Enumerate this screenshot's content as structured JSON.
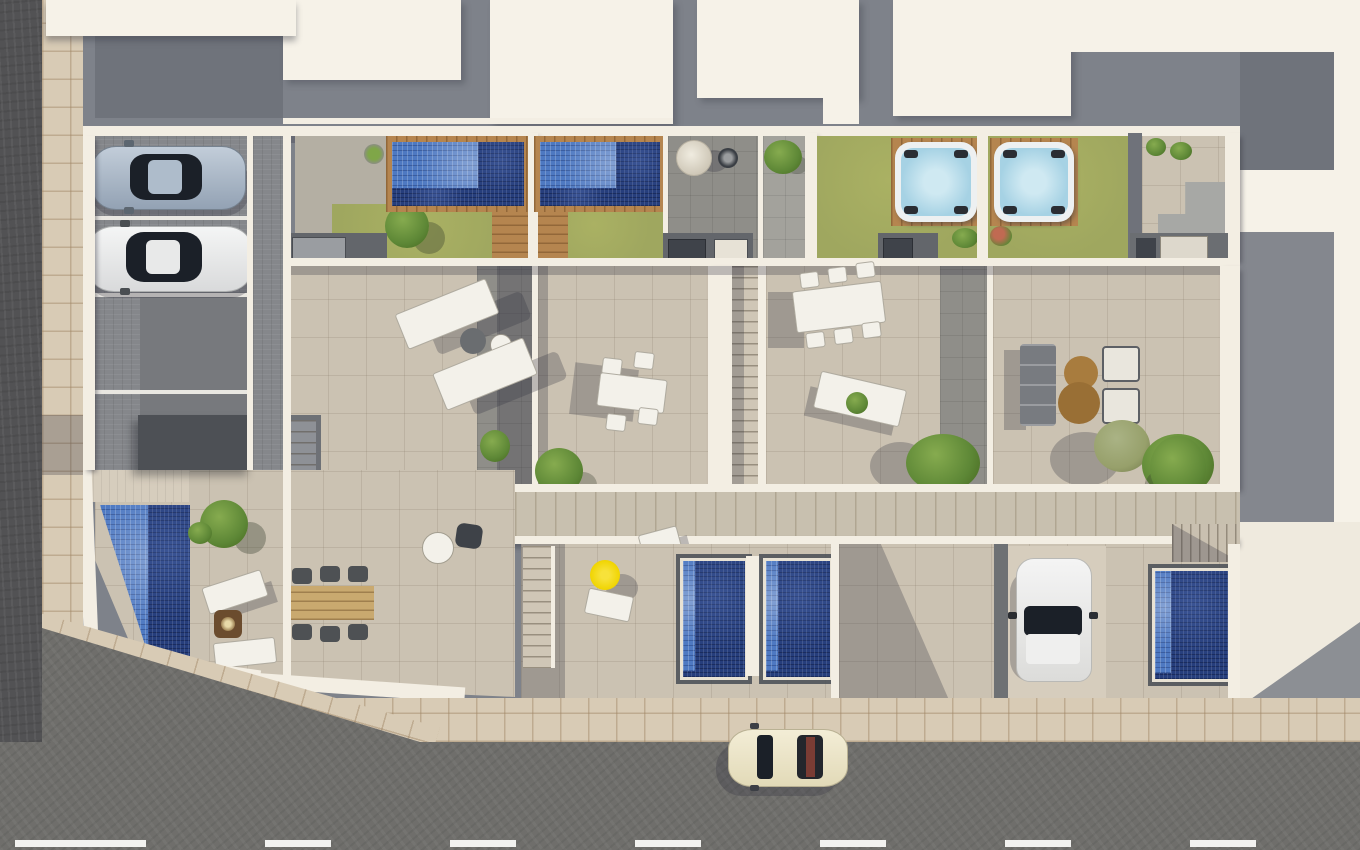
{
  "meta": {
    "title": "Aerial 3D render of residential complex with rooftop terraces and pools",
    "render_type": "architectural-aerial-visualization",
    "visible_text": []
  },
  "colors": {
    "asphalt": "#6f6e6b",
    "asphalt_dark": "#525254",
    "road_line": "#f2f2f0",
    "sidewalk": "#d8cbb5",
    "roof_white": "#f6f2e8",
    "roof_gray": "#7e828a",
    "roof_gray_dark": "#6f737b",
    "wall": "#f3eee3",
    "terrace": "#cbc2b2",
    "walkway_gray": "#8f8e89",
    "paving_gray": "#85878b",
    "charcoal": "#4d5055",
    "lawn": "#9fa75f",
    "lawn_light": "#aab163",
    "pool_blue": "#4e79c2",
    "pool_navy": "#263e7c",
    "wood": "#b5854f",
    "wood_light": "#c8c0af",
    "tub_shell": "#edf0f1",
    "tub_water": "#a6d2e4",
    "white_furn": "#f3f1ea",
    "gray_furn": "#787b80",
    "brown_table": "#a87c3e",
    "umbrella": "#f0d400",
    "car_silver": "#a9b7c6",
    "car_white": "#eceded",
    "car_cream": "#ece5c8",
    "glass": "#1b2028",
    "plant": "#5d8736",
    "plant_light": "#86ab4f",
    "sage": "#97a06b",
    "shadow": "rgba(45,48,60,0.28)"
  },
  "scene": {
    "units": [
      "corner-unit",
      "unit-1",
      "unit-2",
      "unit-3",
      "unit-4"
    ],
    "objects": [
      "left-road",
      "bottom-road",
      "road-lane-dashes",
      "sidewalk",
      "parking-area",
      "parking-stripes",
      "silver-car",
      "white-car",
      "cream-car",
      "driveway-white-car",
      "rooftop-pool-1",
      "rooftop-pool-2",
      "hot-tub-1",
      "hot-tub-2",
      "corner-pool",
      "plunge-pool-1",
      "plunge-pool-2",
      "plunge-pool-3",
      "lawn-1",
      "lawn-2",
      "lawn-3",
      "lawn-4",
      "sun-loungers",
      "dining-table-white",
      "dining-table-long",
      "dining-table-wood",
      "lounge-sofa",
      "coffee-tables-brown",
      "armchairs",
      "fire-pit",
      "yellow-umbrella",
      "hanging-chair",
      "fire-bowl",
      "outdoor-kitchen-units",
      "central-staircase",
      "garden-stairs",
      "wood-walkway",
      "palms-and-plants",
      "round-side-table"
    ]
  }
}
